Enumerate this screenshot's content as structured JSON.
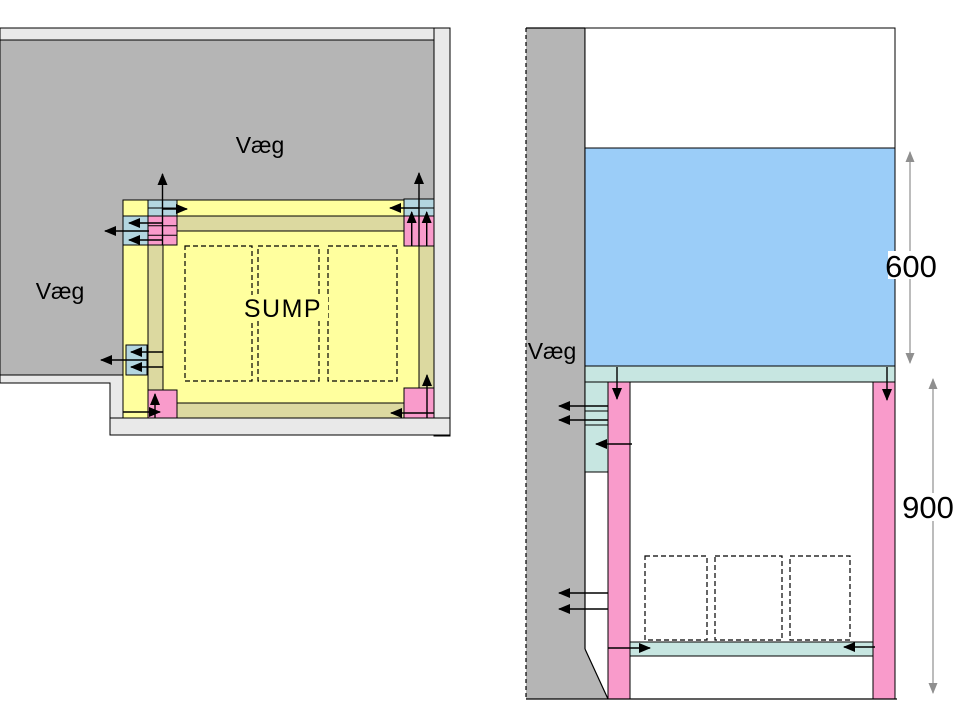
{
  "plan_view": {
    "wall_label_top": "Væg",
    "wall_label_left": "Væg",
    "sump_label": "SUMP"
  },
  "side_view": {
    "wall_label": "Væg",
    "water_height": "600",
    "stand_height": "900"
  },
  "colors": {
    "wall_gray": "#b5b5b5",
    "outline_gray": "#e9e9e9",
    "sump_yellow": "#ffff9e",
    "frame_tan": "#dcd9a0",
    "bracket_blue": "#b3d6e0",
    "panel_cyan": "#c7e6e1",
    "leg_pink": "#f99bcb",
    "water_blue": "#9bcdf8",
    "tank_white": "#ffffff",
    "dimension_gray": "#8f8f8f"
  }
}
